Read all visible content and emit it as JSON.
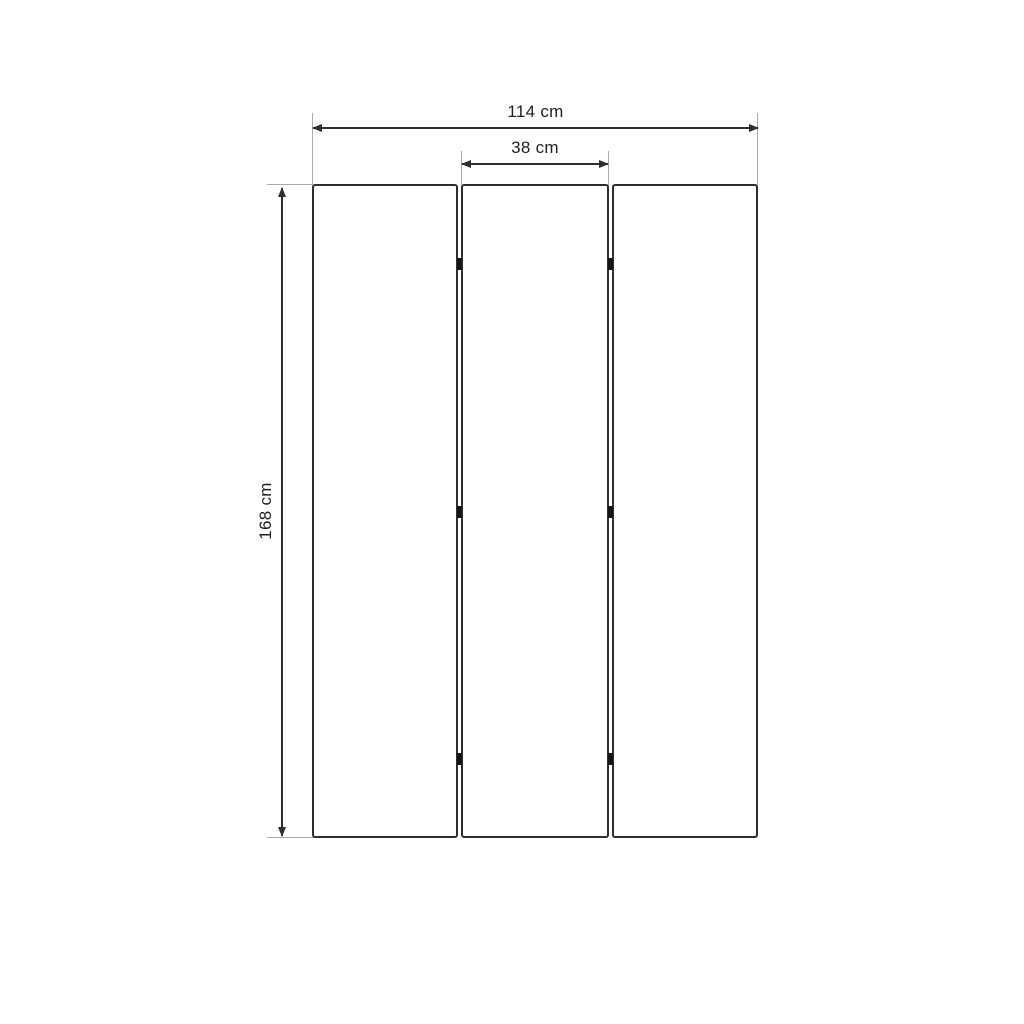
{
  "drawing": {
    "type": "dimension-drawing",
    "subject": "three-panel folding screen, front elevation",
    "background": "#ffffff"
  },
  "colors": {
    "line": "#2e2e2e",
    "extension": "#a9a9a9",
    "hinge": "#161616",
    "text": "#1f1f1f",
    "panel_fill": "#ffffff"
  },
  "dimensions": {
    "overall_width": {
      "label": "114 cm",
      "value": 114,
      "unit": "cm",
      "orientation": "horizontal"
    },
    "panel_width": {
      "label": "38 cm",
      "value": 38,
      "unit": "cm",
      "orientation": "horizontal"
    },
    "overall_height": {
      "label": "168 cm",
      "value": 168,
      "unit": "cm",
      "orientation": "vertical"
    }
  },
  "panels": [
    {
      "name": "left-panel"
    },
    {
      "name": "middle-panel"
    },
    {
      "name": "right-panel"
    }
  ],
  "hinges": {
    "per_gap": 3,
    "gaps": 2,
    "positions": [
      "top",
      "middle",
      "bottom"
    ]
  }
}
